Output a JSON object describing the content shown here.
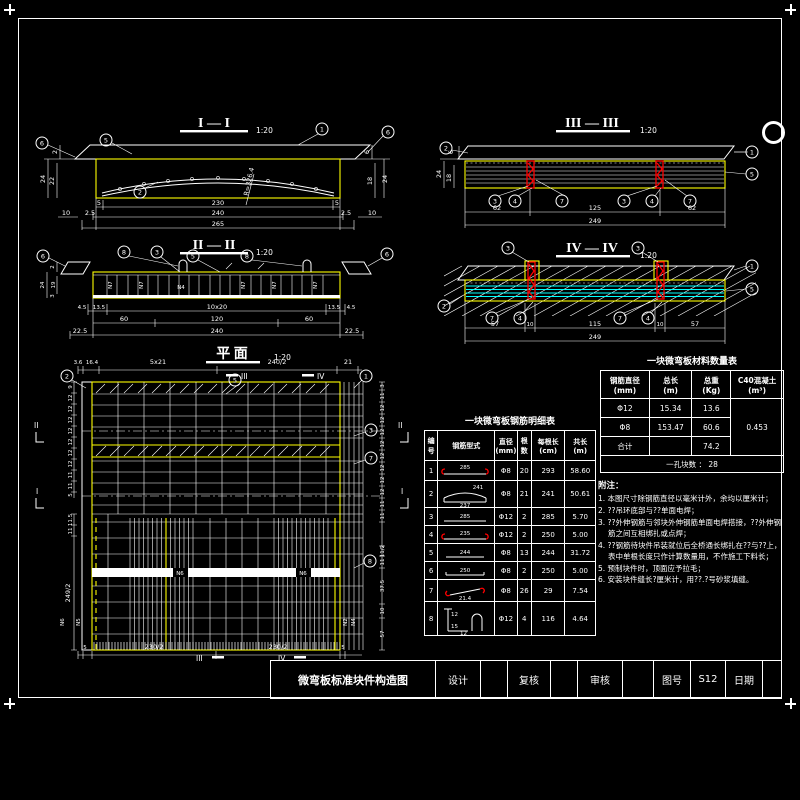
{
  "sheet": {
    "bg": "#000000",
    "line": "#ffffff",
    "accent": "#ffff00",
    "red": "#ff0000",
    "cyan": "#00ffff"
  },
  "sections": {
    "s1": {
      "title": "I — I",
      "scale": "1:20",
      "radius": "R=326.4",
      "dim_r1": [
        "5",
        "230",
        "5"
      ],
      "dim_r2": [
        "2.5",
        "240",
        "2.5"
      ],
      "dim_r3": "265",
      "dim_side": "10",
      "left": [
        "2",
        "24",
        "22"
      ],
      "right": [
        "6",
        "18",
        "24"
      ],
      "callouts": [
        "6",
        "5",
        "1",
        "2",
        "6"
      ]
    },
    "s3": {
      "title": "III — III",
      "scale": "1:20",
      "dim_r1": [
        "62",
        "125",
        "62"
      ],
      "dim_r2": "249",
      "left": [
        "6",
        "24",
        "18"
      ],
      "callouts": [
        "2",
        "1",
        "5",
        "3",
        "4",
        "7",
        "3",
        "4",
        "7"
      ]
    },
    "s2": {
      "title": "II — II",
      "scale": "1:20",
      "dim_r1": [
        "4.5",
        "13.5",
        "10x20",
        "13.5",
        "4.5"
      ],
      "dim_r2": [
        "60",
        "120",
        "60"
      ],
      "dim_r3": [
        "22.5",
        "240",
        "22.5"
      ],
      "left": [
        "2",
        "19",
        "24",
        "3"
      ],
      "labels": [
        "N7",
        "N7",
        "N7",
        "N7",
        "N7",
        "N4"
      ],
      "callouts": [
        "6",
        "8",
        "3",
        "5",
        "8",
        "6"
      ]
    },
    "s4": {
      "title": "IV — IV",
      "scale": "1:20",
      "dim_r1": [
        "57",
        "10",
        "115",
        "10",
        "57"
      ],
      "dim_r2": "249",
      "callouts": [
        "3",
        "3",
        "1",
        "5",
        "2",
        "7",
        "4",
        "7",
        "4"
      ]
    },
    "plan": {
      "title": "平 面",
      "scale": "1:20",
      "dim_top": [
        "3.6",
        "16.4",
        "5x21",
        "240/2",
        "21"
      ],
      "dim_bottom": [
        "5",
        "230/2",
        "230/2",
        "5"
      ],
      "left_chain": [
        "9",
        "12",
        "12",
        "12",
        "12",
        "12",
        "12",
        "12",
        "11",
        "11",
        "5"
      ],
      "left_lower": [
        "11.5",
        "11",
        "249/2"
      ],
      "right_chain": [
        "3",
        "11",
        "12",
        "12",
        "12",
        "12",
        "12",
        "12",
        "12",
        "12",
        "11",
        "11"
      ],
      "right_lower": [
        "11/2",
        "11",
        "37.5",
        "10",
        "57"
      ],
      "section_flags": {
        "v": "III",
        "v2": "IV",
        "h_upper": "II",
        "h_lower": "I"
      },
      "band_labels": [
        "N6",
        "N6"
      ],
      "left_labels": [
        "N6",
        "N5"
      ],
      "right_labels": [
        "N2",
        "N4"
      ],
      "callouts": [
        "2",
        "5",
        "1",
        "3",
        "7",
        "8"
      ]
    }
  },
  "material_table": {
    "title": "一块微弯板材料数量表",
    "headers": [
      "钢筋直径\n(mm)",
      "总长\n(m)",
      "总重\n(Kg)",
      "C40混凝土\n(m³)"
    ],
    "rows": [
      [
        "Φ12",
        "15.34",
        "13.6"
      ],
      [
        "Φ8",
        "153.47",
        "60.6"
      ],
      [
        "合计",
        "",
        "74.2"
      ]
    ],
    "concrete": "0.453",
    "footer": "一孔块数 ：  28"
  },
  "rebar_table": {
    "title": "一块微弯板钢筋明细表",
    "headers": [
      "编\n号",
      "钢筋型式",
      "直径\n(mm)",
      "根\n数",
      "每根长\n(cm)",
      "共长\n(m)"
    ],
    "rows": [
      {
        "no": "1",
        "dia": "Φ8",
        "count": "20",
        "len": "293",
        "total": "58.60",
        "labels": [
          "285"
        ]
      },
      {
        "no": "2",
        "dia": "Φ8",
        "count": "21",
        "len": "241",
        "total": "50.61",
        "labels": [
          "241",
          "237"
        ]
      },
      {
        "no": "3",
        "dia": "Φ12",
        "count": "2",
        "len": "285",
        "total": "5.70",
        "labels": [
          "285"
        ]
      },
      {
        "no": "4",
        "dia": "Φ12",
        "count": "2",
        "len": "250",
        "total": "5.00",
        "labels": [
          "235"
        ]
      },
      {
        "no": "5",
        "dia": "Φ8",
        "count": "13",
        "len": "244",
        "total": "31.72",
        "labels": [
          "244"
        ]
      },
      {
        "no": "6",
        "dia": "Φ8",
        "count": "2",
        "len": "250",
        "total": "5.00",
        "labels": [
          "250"
        ]
      },
      {
        "no": "7",
        "dia": "Φ8",
        "count": "26",
        "len": "29",
        "total": "7.54",
        "labels": [
          "21.4"
        ]
      },
      {
        "no": "8",
        "dia": "Φ12",
        "count": "4",
        "len": "116",
        "total": "4.64",
        "labels": [
          "12",
          "15",
          "12"
        ]
      }
    ]
  },
  "notes": {
    "title": "附注：",
    "items": [
      "1. 本图尺寸除钢筋直径以毫米计外，余均以厘米计；",
      "2. ??吊环底部与??单面电焊；",
      "3. ??外伸钢筋与邻块外伸钢筋单面电焊搭接，??外伸钢筋之间互相绑扎或点焊；",
      "4. ??钢筋待块件吊装就位后全桥通长绑扎在??与??上，表中单根长度只作计算数量用，不作施工下料长；",
      "5. 预制块件时，顶面应予拉毛；",
      "6. 安装块件缝长?厘米计，用??.?号砂浆填缝。"
    ]
  },
  "titleblock": {
    "drawing_title": "微弯板标准块件构造图",
    "design_label": "设计",
    "check_label": "复核",
    "review_label": "审核",
    "figno_label": "图号",
    "figno_value": "S12",
    "date_label": "日期"
  }
}
